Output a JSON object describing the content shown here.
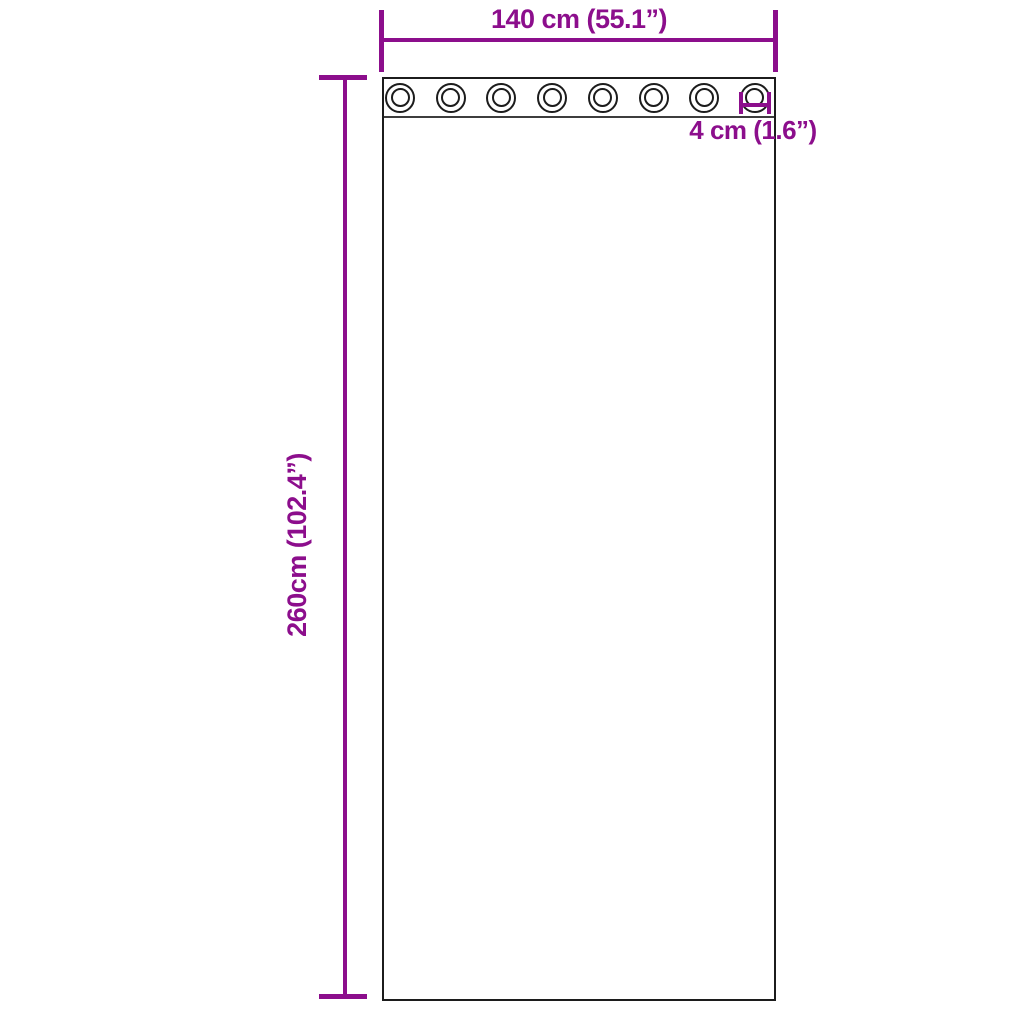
{
  "labels": {
    "width": "140 cm (55.1”)",
    "height": "260cm (102.4”)",
    "grommet_diameter": "4 cm (1.6”)"
  },
  "curtain": {
    "grommet_count": 8
  },
  "colors": {
    "dimension": "#8C0E8C",
    "outline": "#1C1C1C",
    "band_line": "#3D3D3D",
    "background": "#FFFFFF"
  }
}
